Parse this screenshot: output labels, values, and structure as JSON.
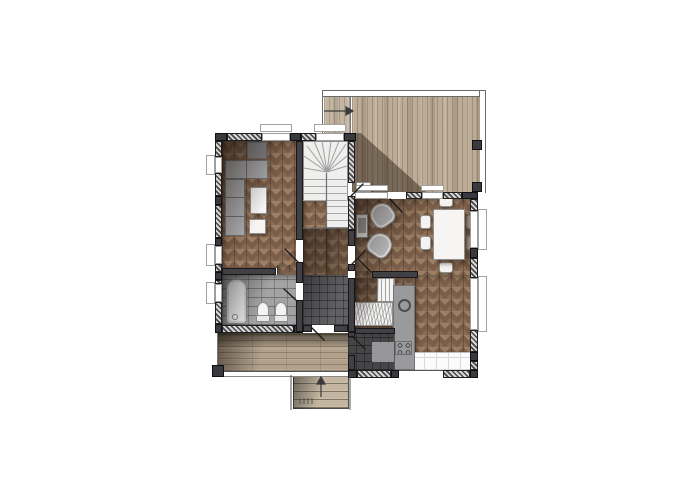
{
  "plan": {
    "kind": "residential-floor-plan-top-down-render",
    "palette": {
      "background": "#ffffff",
      "parquet_base": "#7b5e49",
      "parquet_light": "#9c7f64",
      "deck_plank": "#bdad97",
      "porch_plank": "#b2a28d",
      "wall_hatch_light": "#d6d6d6",
      "wall_hatch_dark": "#474747",
      "wall_block": "#3a3a3e",
      "tile_gray": "#a3a3a3",
      "tile_dark": "#77777b",
      "tile_white": "#fbfbfb",
      "fixture_white": "#f6f5f3",
      "furniture_gray": "#aeaeb0",
      "shadow": "rgba(20,13,8,0.55)"
    },
    "rooms": [
      {
        "id": "living-room",
        "floor": "herringbone-parquet",
        "furniture": [
          "corner-sofa",
          "armchair",
          "coffee-table",
          "ottoman-table"
        ]
      },
      {
        "id": "stairwell",
        "floor": "white",
        "furniture": [
          "u-shaped-staircase-with-winder"
        ]
      },
      {
        "id": "stair-hall",
        "floor": "herringbone-parquet",
        "furniture": []
      },
      {
        "id": "dining-room",
        "floor": "herringbone-parquet",
        "furniture": [
          "dining-table",
          "chair",
          "chair",
          "chair",
          "chair",
          "chair",
          "chair",
          "lounge-chair",
          "lounge-chair",
          "console-table"
        ]
      },
      {
        "id": "kitchen",
        "floor": "herringbone-parquet-and-white-tile",
        "furniture": [
          "counter-with-rack",
          "counter-cabinet",
          "tall-counter-run",
          "sink",
          "cooktop-4-burner"
        ]
      },
      {
        "id": "bathroom",
        "floor": "gray-tile",
        "furniture": [
          "bathtub",
          "toilet",
          "bidet"
        ]
      },
      {
        "id": "hallway",
        "floor": "dark-stone-tile",
        "furniture": []
      },
      {
        "id": "mudroom-entry",
        "floor": "dark-stone-tile",
        "furniture": []
      }
    ],
    "outdoor": [
      {
        "id": "deck-terrace",
        "floor": "vertical-wood-planks",
        "annotation": "direction-arrow-right"
      },
      {
        "id": "covered-porch",
        "floor": "horizontal-wood-planks"
      },
      {
        "id": "entry-steps",
        "treads": 4,
        "annotation": "direction-arrow-up"
      }
    ],
    "symbols": [
      "hatched-exterior-walls",
      "window-openings-with-sills",
      "door-swing-leaves",
      "corner-posts",
      "cast-shadows"
    ]
  }
}
